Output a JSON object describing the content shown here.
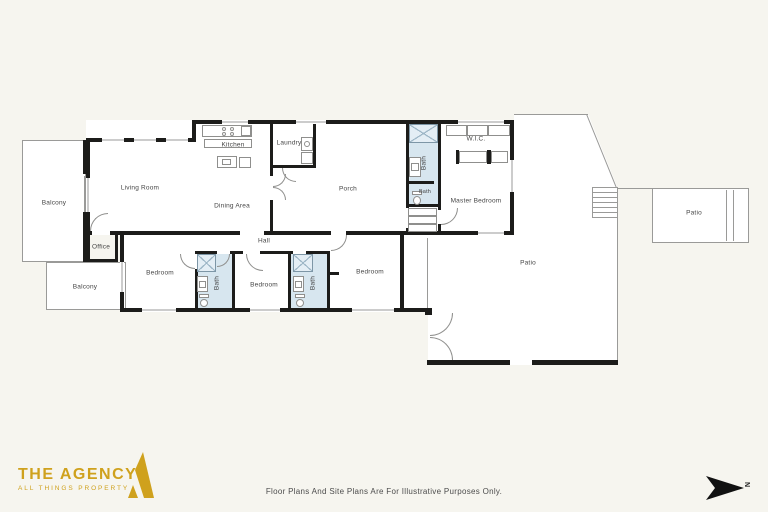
{
  "page": {
    "background": "#f6f5ef",
    "type": "real-estate-floor-plan"
  },
  "rooms": [
    {
      "id": "balcony-upper",
      "label": "Balcony"
    },
    {
      "id": "living-room",
      "label": "Living Room"
    },
    {
      "id": "kitchen",
      "label": "Kitchen"
    },
    {
      "id": "laundry",
      "label": "Laundry"
    },
    {
      "id": "dining-area",
      "label": "Dining Area"
    },
    {
      "id": "porch",
      "label": "Porch"
    },
    {
      "id": "bath-master-upper",
      "label": "Bath"
    },
    {
      "id": "bath-master-lower",
      "label": "Bath"
    },
    {
      "id": "wic",
      "label": "W.I.C."
    },
    {
      "id": "master-bedroom",
      "label": "Master Bedroom"
    },
    {
      "id": "office",
      "label": "Office"
    },
    {
      "id": "balcony-lower",
      "label": "Balcony"
    },
    {
      "id": "bedroom-left",
      "label": "Bedroom"
    },
    {
      "id": "hall",
      "label": "Hall"
    },
    {
      "id": "bath-hall-left",
      "label": "Bath"
    },
    {
      "id": "bedroom-middle",
      "label": "Bedroom"
    },
    {
      "id": "bath-hall-right",
      "label": "Bath"
    },
    {
      "id": "bedroom-right",
      "label": "Bedroom"
    },
    {
      "id": "patio-main",
      "label": "Patio"
    },
    {
      "id": "patio-upper",
      "label": "Patio"
    }
  ],
  "footer": {
    "brand_name": "THE AGENCY",
    "brand_tagline": "ALL THINGS PROPERTY",
    "disclaimer": "Floor Plans And Site Plans Are For Illustrative Purposes Only.",
    "north_label": "N"
  },
  "colors": {
    "wall": "#1c1c1a",
    "floor": "#ffffff",
    "bath_fill": "#d7e6ef",
    "outline_line": "#9a9a98",
    "brand_gold": "#cfa11d",
    "label_text": "#454545",
    "north_arrow": "#111111"
  }
}
